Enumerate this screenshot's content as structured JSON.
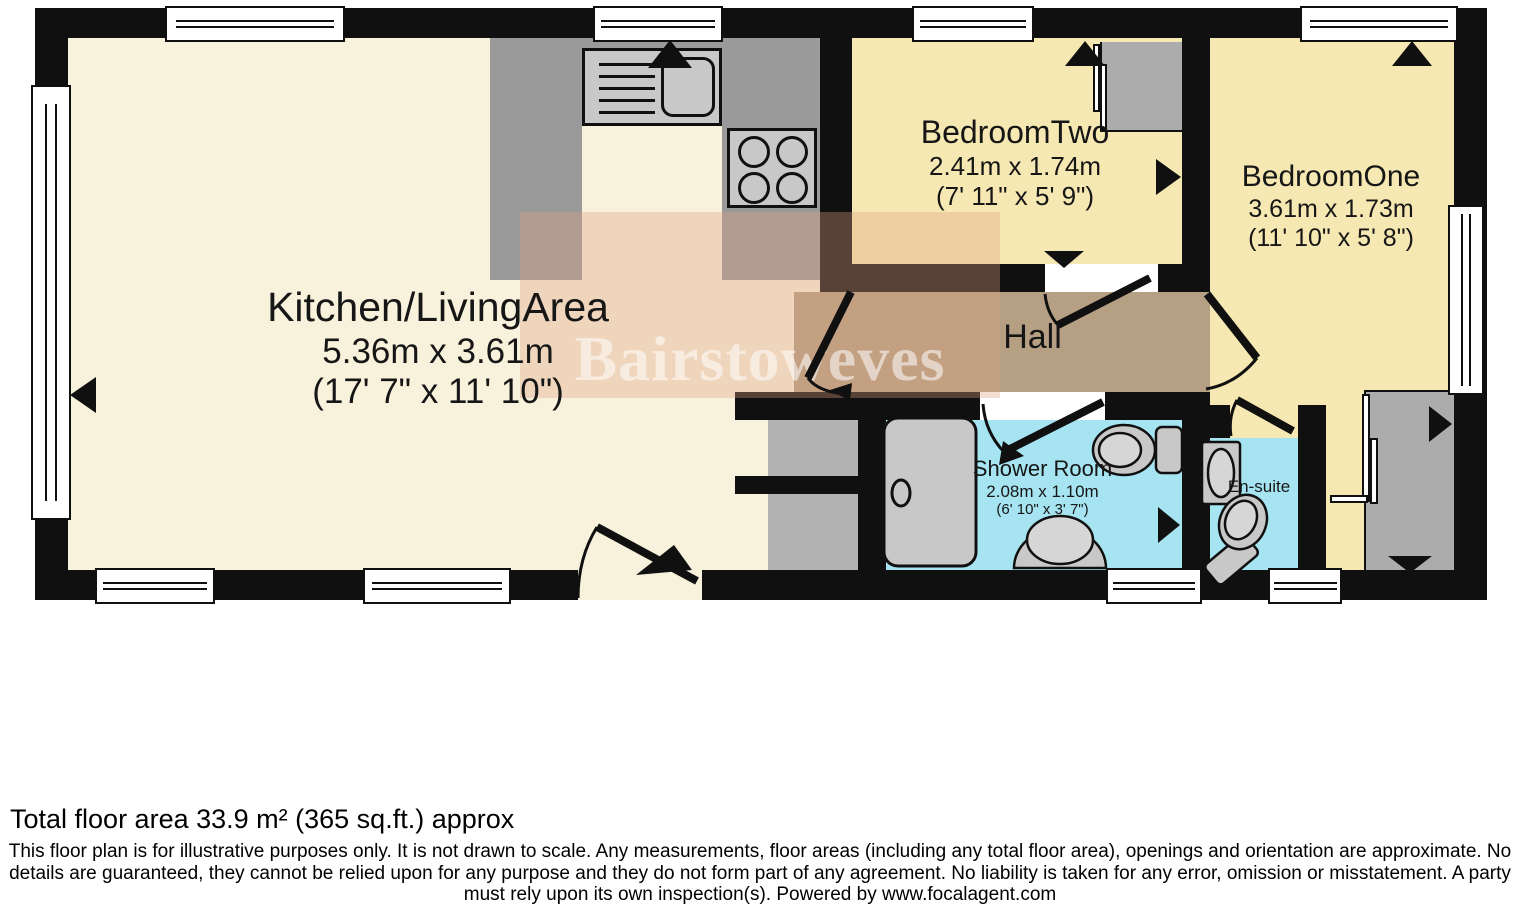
{
  "plan": {
    "watermark": "Bairstoweves",
    "rooms": {
      "kitchen_living": {
        "name": "Kitchen/LivingArea",
        "metric": "5.36m x 3.61m",
        "imperial": "(17' 7\" x 11' 10\")"
      },
      "bedroom_two": {
        "name": "BedroomTwo",
        "metric": "2.41m x 1.74m",
        "imperial": "(7' 11\" x 5' 9\")"
      },
      "bedroom_one": {
        "name": "BedroomOne",
        "metric": "3.61m x 1.73m",
        "imperial": "(11' 10\" x 5' 8\")"
      },
      "hall": {
        "name": "Hall"
      },
      "shower_room": {
        "name": "Shower Room",
        "metric": "2.08m x 1.10m",
        "imperial": "(6' 10\" x 3' 7\")"
      },
      "en_suite": {
        "name": "En-suite"
      }
    },
    "colors": {
      "wall": "#101010",
      "kitchen_floor": "#F8F2DC",
      "bedroom_floor": "#F6E8B2",
      "hall_floor": "#B5A084",
      "wet_room_floor": "#A6E4F2",
      "counter_gray": "#9A9A9A",
      "watermark_tint": "#E0A082"
    }
  },
  "footer": {
    "total_area": "Total floor area 33.9 m² (365 sq.ft.) approx",
    "disclaimer_lines": [
      "This floor plan is for illustrative purposes only. It is not drawn to scale. Any measurements, floor areas (including any total floor area), openings and orientation are approximate. No",
      "details are guaranteed, they cannot be relied upon for any purpose and they do not form part of any agreement. No liability is taken for any error, omission or misstatement. A party",
      "must rely upon its own inspection(s). Powered by www.focalagent.com"
    ]
  }
}
